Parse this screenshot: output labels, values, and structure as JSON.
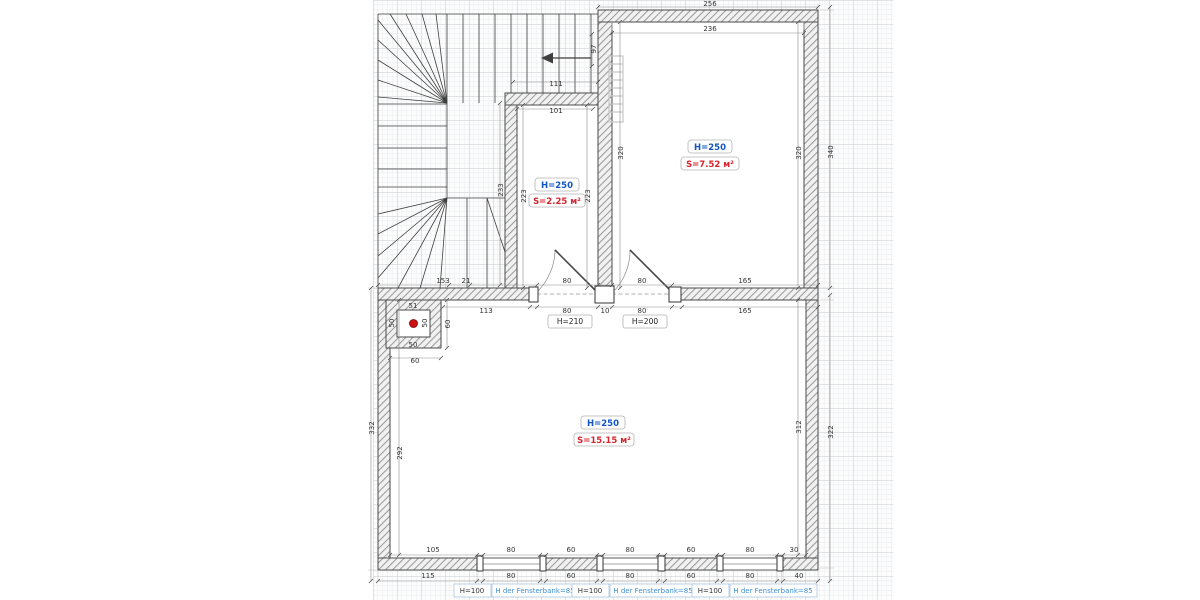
{
  "drawing": {
    "kind": "floor-plan",
    "colors": {
      "height_label_blue": "#1256c4",
      "area_label_red": "#d6252e",
      "sill_label_blue": "#3d8fd6",
      "vent_dot_red": "#cc1111",
      "wall_stroke": "#4a4a4a",
      "hatch_gray": "#9b9b9b",
      "grid_minor": "#ebedf0",
      "grid_major": "#d7dbdf"
    }
  },
  "rooms": {
    "small": {
      "height_label": "H=250",
      "area_label": "S=2.25 м²"
    },
    "upper_right": {
      "height_label": "H=250",
      "area_label": "S=7.52 м²"
    },
    "main": {
      "height_label": "H=250",
      "area_label": "S=15.15 м²"
    }
  },
  "doors": {
    "left": {
      "label": "H=210"
    },
    "right": {
      "label": "H=200"
    }
  },
  "windows": {
    "w1": {
      "height": "H=100",
      "sill": "H der Fensterbank=85"
    },
    "w2": {
      "height": "H=100",
      "sill": "H der Fensterbank=85"
    },
    "w3": {
      "height": "H=100",
      "sill": "H der Fensterbank=85"
    }
  },
  "symbols": {
    "stair_arrow": "arrow-left",
    "shaft_marker": "red-dot",
    "radiator": "ladder"
  },
  "dim_labels": [
    {
      "v": "256",
      "x": 710,
      "y": 6
    },
    {
      "v": "236",
      "x": 710,
      "y": 31
    },
    {
      "v": "97",
      "x": 596,
      "y": 49,
      "r": -90
    },
    {
      "v": "111",
      "x": 556,
      "y": 86
    },
    {
      "v": "101",
      "x": 556,
      "y": 113
    },
    {
      "v": "320",
      "x": 623,
      "y": 153,
      "r": -90
    },
    {
      "v": "320",
      "x": 801,
      "y": 153,
      "r": -90
    },
    {
      "v": "340",
      "x": 833,
      "y": 152,
      "r": -90
    },
    {
      "v": "233",
      "x": 503,
      "y": 190,
      "r": -90
    },
    {
      "v": "223",
      "x": 526,
      "y": 196,
      "r": -90
    },
    {
      "v": "223",
      "x": 590,
      "y": 196,
      "r": -90
    },
    {
      "v": "153",
      "x": 443,
      "y": 283
    },
    {
      "v": "21",
      "x": 466,
      "y": 283
    },
    {
      "v": "80",
      "x": 567,
      "y": 283
    },
    {
      "v": "80",
      "x": 642,
      "y": 283
    },
    {
      "v": "165",
      "x": 745,
      "y": 283
    },
    {
      "v": "113",
      "x": 486,
      "y": 313
    },
    {
      "v": "80",
      "x": 567,
      "y": 313
    },
    {
      "v": "10",
      "x": 605,
      "y": 313
    },
    {
      "v": "80",
      "x": 642,
      "y": 313
    },
    {
      "v": "165",
      "x": 745,
      "y": 313
    },
    {
      "v": "51",
      "x": 413,
      "y": 308
    },
    {
      "v": "50",
      "x": 413,
      "y": 347
    },
    {
      "v": "50",
      "x": 394,
      "y": 323,
      "r": -90
    },
    {
      "v": "50",
      "x": 427,
      "y": 323,
      "r": -90
    },
    {
      "v": "60",
      "x": 415,
      "y": 363
    },
    {
      "v": "60",
      "x": 450,
      "y": 324,
      "r": -90
    },
    {
      "v": "332",
      "x": 374,
      "y": 428,
      "r": -90
    },
    {
      "v": "292",
      "x": 402,
      "y": 453,
      "r": -90
    },
    {
      "v": "312",
      "x": 801,
      "y": 427,
      "r": -90
    },
    {
      "v": "322",
      "x": 833,
      "y": 432,
      "r": -90
    },
    {
      "v": "105",
      "x": 433,
      "y": 552
    },
    {
      "v": "80",
      "x": 511,
      "y": 552
    },
    {
      "v": "60",
      "x": 571,
      "y": 552
    },
    {
      "v": "80",
      "x": 630,
      "y": 552
    },
    {
      "v": "60",
      "x": 691,
      "y": 552
    },
    {
      "v": "80",
      "x": 750,
      "y": 552
    },
    {
      "v": "30",
      "x": 794,
      "y": 552
    },
    {
      "v": "115",
      "x": 428,
      "y": 578
    },
    {
      "v": "80",
      "x": 511,
      "y": 578
    },
    {
      "v": "60",
      "x": 571,
      "y": 578
    },
    {
      "v": "80",
      "x": 630,
      "y": 578
    },
    {
      "v": "60",
      "x": 691,
      "y": 578
    },
    {
      "v": "80",
      "x": 750,
      "y": 578
    },
    {
      "v": "40",
      "x": 799,
      "y": 578
    }
  ]
}
